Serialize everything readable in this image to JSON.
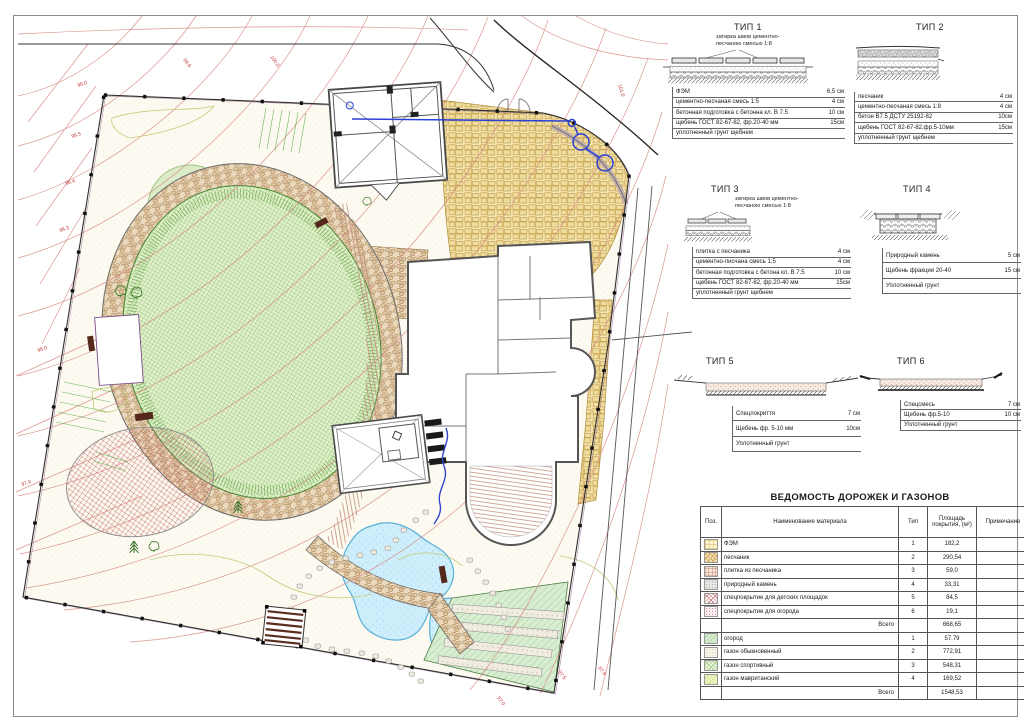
{
  "plan": {
    "contour_labels": [
      "99.6",
      "100.0",
      "101.0",
      "98.0",
      "98.5",
      "98.4",
      "98.3",
      "98.0",
      "97.9",
      "97.5",
      "97.5",
      "97.0"
    ],
    "colors": {
      "contour": "#d4837b",
      "boundary": "#2e2e2e",
      "water_line": "#2a41d6",
      "pond_edge": "#58b0d8",
      "stone": "#f2e3b2",
      "cobble": "#ead9bd",
      "sport_lawn": "#e3f0cd",
      "garden": "#d9edd2"
    }
  },
  "sections": [
    {
      "title": "ТИП 1",
      "callout": "затирка швов цементно-\nпесчаною смесью 1:8",
      "layers": [
        [
          "ФЭМ",
          "6,5 см"
        ],
        [
          "цементно-песчаная смесь 1:5",
          "4 см"
        ],
        [
          "бетонная подготовка с бетонна кл. В 7.5",
          "10 см"
        ],
        [
          "щебень ГОСТ 82-67-82, фр.20-40 мм",
          "15см"
        ],
        [
          "уплотненный грунт щебнем",
          ""
        ]
      ]
    },
    {
      "title": "ТИП 2",
      "layers": [
        [
          "песчаник",
          "4 см"
        ],
        [
          "цементно-песчаная смесь 1:8",
          "4 см"
        ],
        [
          "бетон В7.5 ДСТУ 25192-82",
          "10см"
        ],
        [
          "щебень ГОСТ 82-67-82,фр.5-10мм",
          "15см"
        ],
        [
          "уплотненный грунт щебнем",
          ""
        ]
      ]
    },
    {
      "title": "ТИП 3",
      "callout": "затирка швов цементно-\nпесчаною смесью 1:8",
      "layers": [
        [
          "плитка с песчаника",
          "4 см"
        ],
        [
          "цементно-писчана смесь 1:5",
          "4 см"
        ],
        [
          "бетонная подготовка с бетона кл. В 7.5",
          "10 см"
        ],
        [
          "щебень ГОСТ 82-67-82, фр.20-40 мм",
          "15см"
        ],
        [
          "уплотненный грунт щебнем",
          ""
        ]
      ]
    },
    {
      "title": "ТИП 4",
      "layers": [
        [
          "Природный камень",
          "5 см"
        ],
        [
          "Щебень фракции 20-40",
          "15 см"
        ],
        [
          "Уплотненный грунт",
          ""
        ]
      ]
    },
    {
      "title": "ТИП 5",
      "layers": [
        [
          "Спецпокриття",
          "7 см"
        ],
        [
          "Щебень фр. 5-10 мм",
          "10см"
        ],
        [
          "Уплотненный грунт",
          ""
        ]
      ]
    },
    {
      "title": "ТИП 6",
      "layers": [
        [
          "Спецсмесь",
          "7 см"
        ],
        [
          "Щебень фр.5-10",
          "10 см"
        ],
        [
          "Уплотненный грунт",
          ""
        ]
      ]
    }
  ],
  "table": {
    "title": "ВЕДОМОСТЬ ДОРОЖЕК И ГАЗОНОВ",
    "headers": [
      "Поз.",
      "Наименование материала",
      "Тип",
      "Площадь покрытия, (м²)",
      "Примечание"
    ],
    "rows": [
      {
        "swatch": "fem",
        "name": "ФЭМ",
        "type": "1",
        "area": "182,2"
      },
      {
        "swatch": "sandstone",
        "name": "песчаник",
        "type": "2",
        "area": "290,54"
      },
      {
        "swatch": "tile",
        "name": "плитка из песчаника",
        "type": "3",
        "area": "59,0"
      },
      {
        "swatch": "natstone",
        "name": "природный камень",
        "type": "4",
        "area": "33,31"
      },
      {
        "swatch": "playground",
        "name": "спецпокрытие для детских площадок",
        "type": "5",
        "area": "84,5"
      },
      {
        "swatch": "gardencover",
        "name": "спецпокрытие для огорода",
        "type": "6",
        "area": "19,1"
      },
      {
        "total": true,
        "name": "Всего",
        "area": "668,65"
      },
      {
        "swatch": "ogorod",
        "name": "огород",
        "type": "1",
        "area": "57,79"
      },
      {
        "swatch": "lawnplain",
        "name": "газон обыкновенный",
        "type": "2",
        "area": "772,91"
      },
      {
        "swatch": "lawnsport",
        "name": "газон спортивный",
        "type": "3",
        "area": "548,31"
      },
      {
        "swatch": "lawnmavr",
        "name": "газон мавританский",
        "type": "4",
        "area": "169,52"
      },
      {
        "total": true,
        "name": "Всего",
        "area": "1548,53"
      }
    ]
  }
}
